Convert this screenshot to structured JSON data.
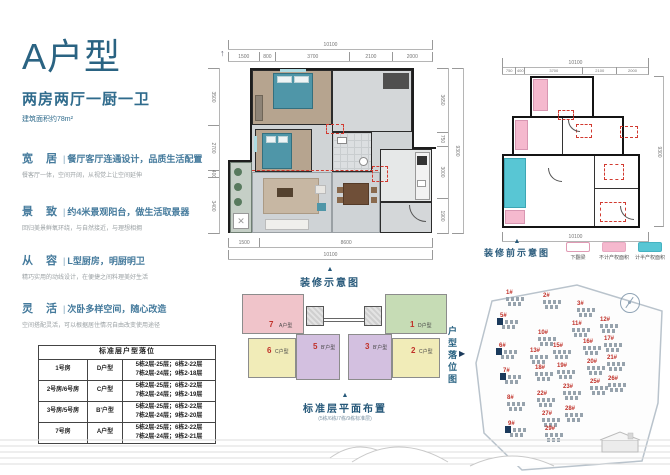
{
  "page": {
    "title": "A户型",
    "subtitle": "两房两厅一厨一卫",
    "area_note": "建筑面积约78m²"
  },
  "features": [
    {
      "key": "宽居",
      "headline": "餐厅客厅连通设计，品质生活配置",
      "desc": "餐客厅一体，空间开阔，从视觉上让空间延伸"
    },
    {
      "key": "景致",
      "headline": "约4米景观阳台，做生活取景器",
      "desc": "回归美景鲜氧环绕，与自然接近，与理想相拥"
    },
    {
      "key": "从容",
      "headline": "L型厨房，明厨明卫",
      "desc": "精巧实用的动线设计，在便捷之间料理美好生活"
    },
    {
      "key": "灵活",
      "headline": "次卧多样空间，随心改造",
      "desc": "空间搭配灵活，可以根据居住情况自由改变使用途径"
    }
  ],
  "table": {
    "title": "标准层户型落位",
    "rows": [
      {
        "room": "1号房",
        "type": "D户型",
        "floors1": "5栋2层-25层；6栋2-22层",
        "floors2": "7栋2层-24层；9栋2-18层"
      },
      {
        "room": "2号房/6号房",
        "type": "C户型",
        "floors1": "5栋2层-25层；6栋2-22层",
        "floors2": "7栋2层-24层；9栋2-19层"
      },
      {
        "room": "3号房/5号房",
        "type": "B'户型",
        "floors1": "5栋2层-25层；6栋2-22层",
        "floors2": "7栋2层-24层；9栋2-20层"
      },
      {
        "room": "7号房",
        "type": "A户型",
        "floors1": "5栋2层-25层；6栋2-22层",
        "floors2": "7栋2层-24层；9栋2-21层"
      }
    ]
  },
  "main_plan": {
    "caption": "装修示意图",
    "dims_top_total": "10100",
    "dims_top": [
      "1500",
      "800",
      "3700",
      "2100",
      "2000"
    ],
    "dims_left": [
      "3500",
      "2700",
      "400",
      "3400"
    ],
    "dims_right": [
      "3650",
      "750",
      "3000",
      "1900"
    ],
    "dims_right_total": "9300",
    "dims_bottom": [
      "1500",
      "8600"
    ],
    "dims_bottom_total": "10100"
  },
  "outline_plan": {
    "caption": "装修前示意图",
    "dims_top_total": "10100",
    "dims_top": [
      "750",
      "400",
      "3700",
      "2100",
      "2000"
    ],
    "dims_right_total": "9300",
    "dims_bottom_total": "10100",
    "legend": [
      {
        "label": "下翻梁",
        "color": "#ffffff"
      },
      {
        "label": "不计产权面积",
        "color": "#f5b9ce"
      },
      {
        "label": "计半产权面积",
        "color": "#58c6d4"
      }
    ]
  },
  "floor_plate": {
    "caption": "标准层平面布置",
    "subcaption": "(5栋/6栋/7栋/9栋标准层)",
    "units": [
      {
        "num": "7",
        "type": "A户型",
        "color": "#f0c4ca"
      },
      {
        "num": "1",
        "type": "D户型",
        "color": "#c6dcb5"
      },
      {
        "num": "6",
        "type": "C户型",
        "color": "#f1ecb8"
      },
      {
        "num": "5",
        "type": "B'户型",
        "color": "#d3c0e0"
      },
      {
        "num": "3",
        "type": "B'户型",
        "color": "#d3c0e0"
      },
      {
        "num": "2",
        "type": "C户型",
        "color": "#f1ecb8"
      }
    ]
  },
  "site_map": {
    "label": "户型落位图",
    "highlight_color": "#1b3a5c",
    "buildings": [
      {
        "id": "1#"
      },
      {
        "id": "2#"
      },
      {
        "id": "3#"
      },
      {
        "id": "5#"
      },
      {
        "id": "10#"
      },
      {
        "id": "11#"
      },
      {
        "id": "12#"
      },
      {
        "id": "6#"
      },
      {
        "id": "13#"
      },
      {
        "id": "15#"
      },
      {
        "id": "16#"
      },
      {
        "id": "17#"
      },
      {
        "id": "7#"
      },
      {
        "id": "18#"
      },
      {
        "id": "19#"
      },
      {
        "id": "20#"
      },
      {
        "id": "21#"
      },
      {
        "id": "8#"
      },
      {
        "id": "22#"
      },
      {
        "id": "23#"
      },
      {
        "id": "25#"
      },
      {
        "id": "26#"
      },
      {
        "id": "9#"
      },
      {
        "id": "27#"
      },
      {
        "id": "28#"
      },
      {
        "id": "29#"
      }
    ]
  },
  "colors": {
    "accent": "#2a6382",
    "red_label": "#c03028",
    "teal_bed": "#4f96a8"
  }
}
